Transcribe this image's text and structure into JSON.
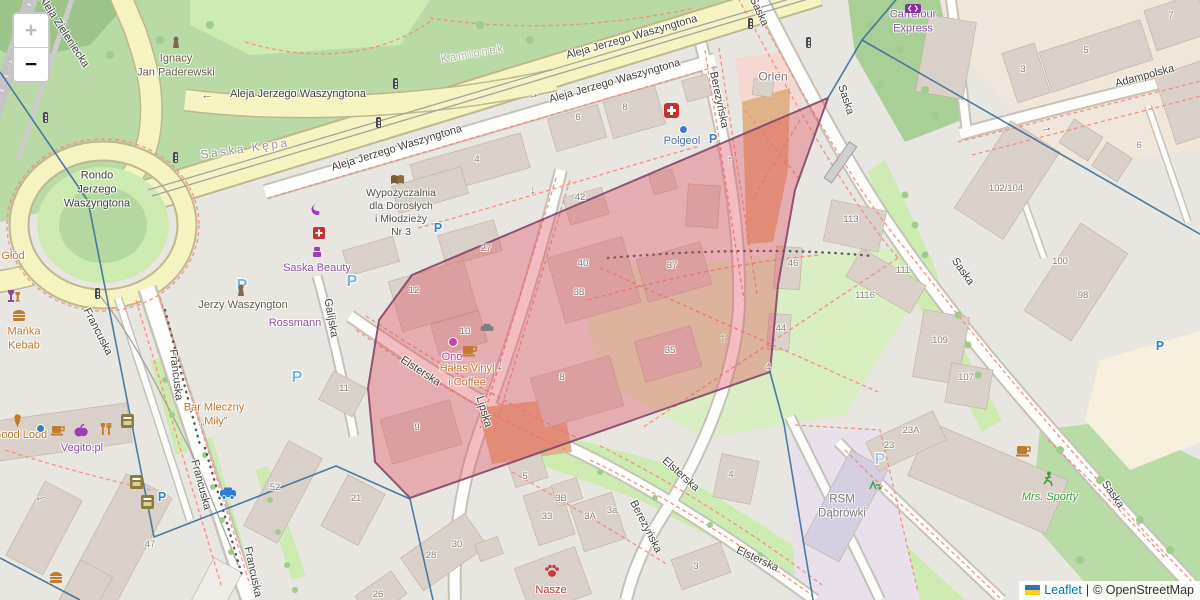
{
  "controls": {
    "zoom_in_label": "+",
    "zoom_out_label": "−"
  },
  "attribution": {
    "leaflet_link": "Leaflet",
    "separator": "|",
    "osm_text": "© OpenStreetMap"
  },
  "districts": {
    "saska_kepa": "Saska Kępa",
    "kamionek": "Kamionek"
  },
  "streets": {
    "aleja_jerzego_waszyngtona": "Aleja Jerzego Waszyngtona",
    "aleja_zieleniecka": "Aleja Zieleniecka",
    "rondo": "Rondo\nJerzego\nWaszyngtona",
    "saska": "Saska",
    "adampolska": "Adampolska",
    "berezynska": "Berezyńska",
    "elsterska": "Elsterska",
    "lipska": "Lipska",
    "francuska": "Francuska",
    "galijska": "Galijska"
  },
  "pois": {
    "paderewski": "Ignacy\nJan Paderewski",
    "library": "Wypożyczalnia\ndla Dorosłych\ni Młodzieży\nNr 3",
    "saska_beauty": "Saska Beauty",
    "jerzy_waszyngton": "Jerzy Waszyngton",
    "rossmann": "Rossmann",
    "manka_kebab": "Mańka\nKebab",
    "glod": "Głód",
    "good_lood": "Good Lood",
    "vegito": "Vegito.pl",
    "bar_mleczny": "Bar Mleczny\n„Miły”",
    "orlen": "Orlen",
    "polgeol": "Polgeol",
    "carrefour": "Carrefour\nExpress",
    "rsm": "RSM\nDąbrówki",
    "mrs_sporty": "Mrs. Sporty",
    "ono": "Ono",
    "halas_vinyl": "Hałas Vinyl\ni Coffee",
    "nasze": "Nasze"
  },
  "house_numbers": [
    "4",
    "6",
    "8",
    "42",
    "40",
    "38",
    "37",
    "35",
    "8",
    "27",
    "12",
    "10",
    "9",
    "11",
    "21",
    "52",
    "47",
    "28",
    "30",
    "26",
    "5",
    "3B",
    "33",
    "3A",
    "3a",
    "3",
    "4",
    "44",
    "46",
    "4",
    "113",
    "111",
    "1116",
    "109",
    "107",
    "102/104",
    "100",
    "98",
    "23A",
    "23",
    "3",
    "5",
    "7",
    "6"
  ],
  "glyphs": {
    "parking": "P",
    "arrow_left": "←",
    "arrow_right": "→",
    "arrow_up": "↑",
    "arrow_down": "↓"
  },
  "icons": [
    "zoom-in-icon",
    "zoom-out-icon",
    "ukraine-flag-icon",
    "hospital-icon",
    "parking-icon",
    "book-icon",
    "statue-icon",
    "coffee-cup-icon",
    "paw-icon",
    "runner-icon",
    "palette-icon",
    "pharmacy-icon",
    "cosmetics-icon",
    "wine-icon",
    "burger-icon",
    "ice-cream-icon",
    "fruit-icon",
    "cutlery-icon",
    "atm-icon",
    "taxi-icon",
    "traffic-light-icon",
    "oneway-arrow-icon",
    "carrefour-icon"
  ],
  "colors": {
    "selection_fill": "#e0485a",
    "selection_stroke": "#7e4066",
    "boundary_line": "#3c6e99",
    "leaflet_link": "#0078a8",
    "road_yellow": "#f5f3bf",
    "park_green": "#b9d9a5",
    "building": "#d9d0c9"
  }
}
